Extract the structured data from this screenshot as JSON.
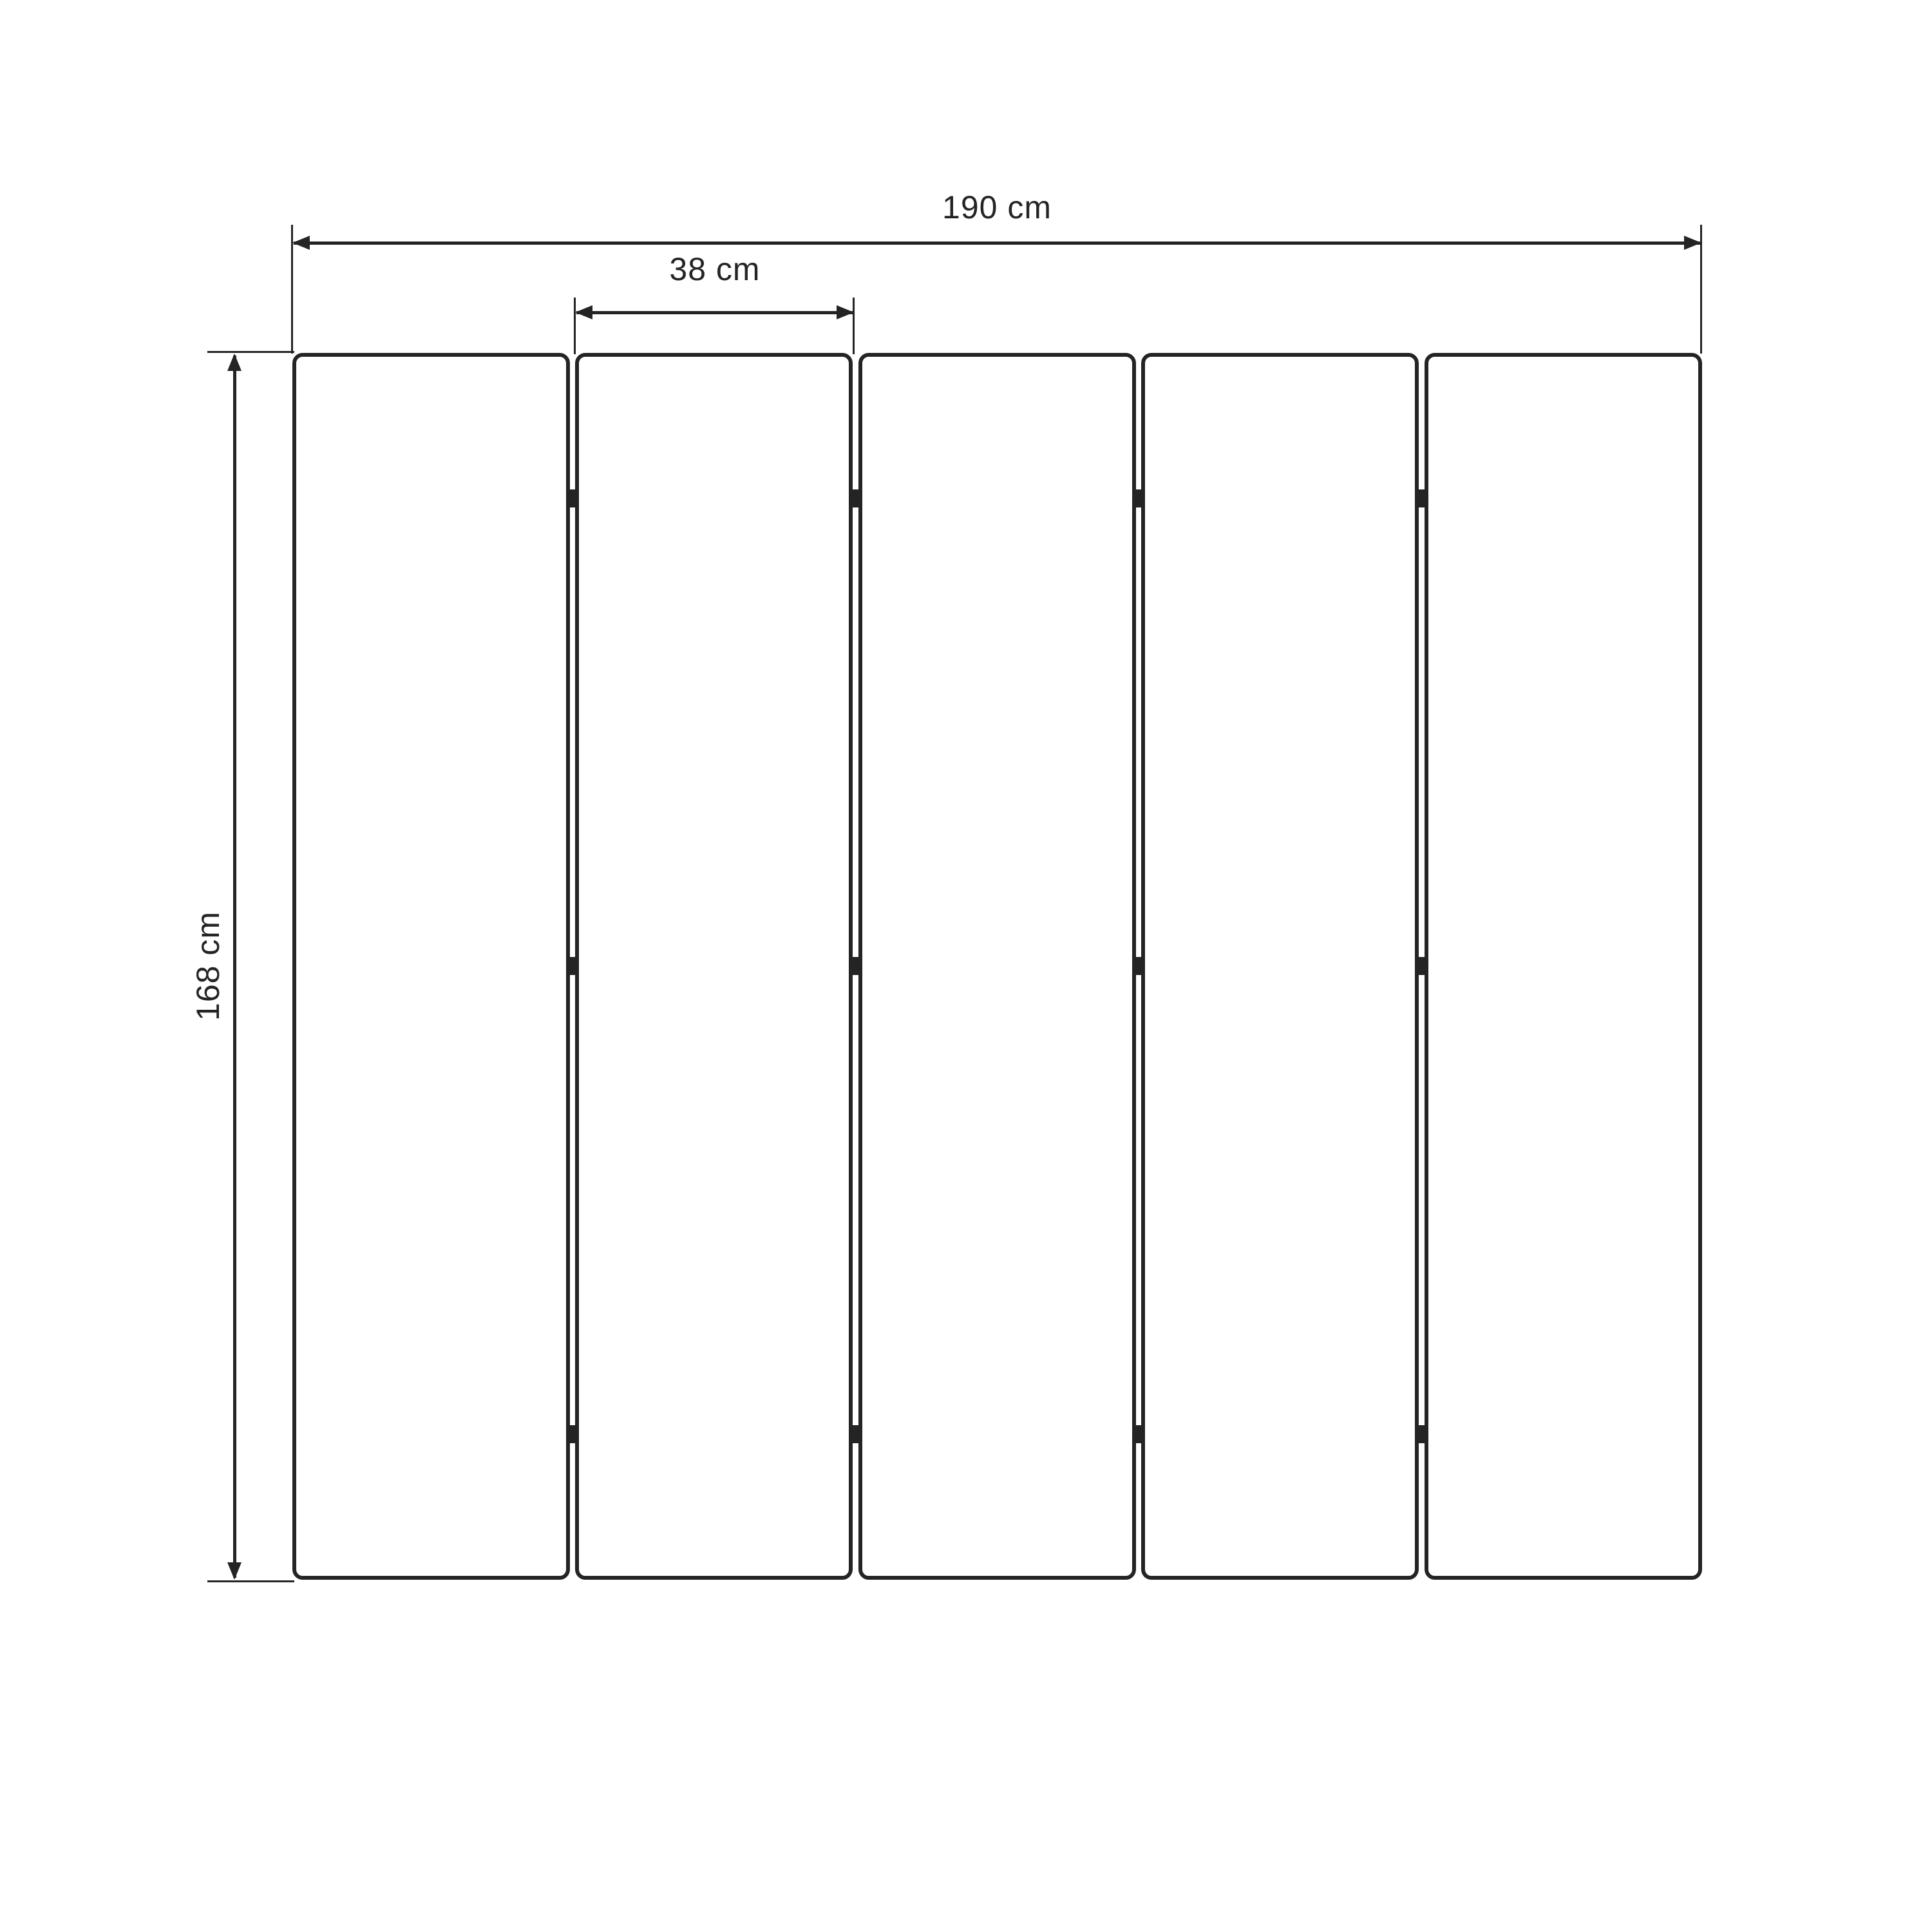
{
  "drawing": {
    "type": "technical-dimension-drawing",
    "subject": "five-panel folding screen, front elevation",
    "panel_count": 5,
    "hinge_rows_per_gap": 3,
    "ink_color": "#242424",
    "background_color": "#ffffff",
    "dimensions": {
      "total_width_label": "190 cm",
      "panel_width_label": "38 cm",
      "height_label": "168 cm"
    }
  }
}
